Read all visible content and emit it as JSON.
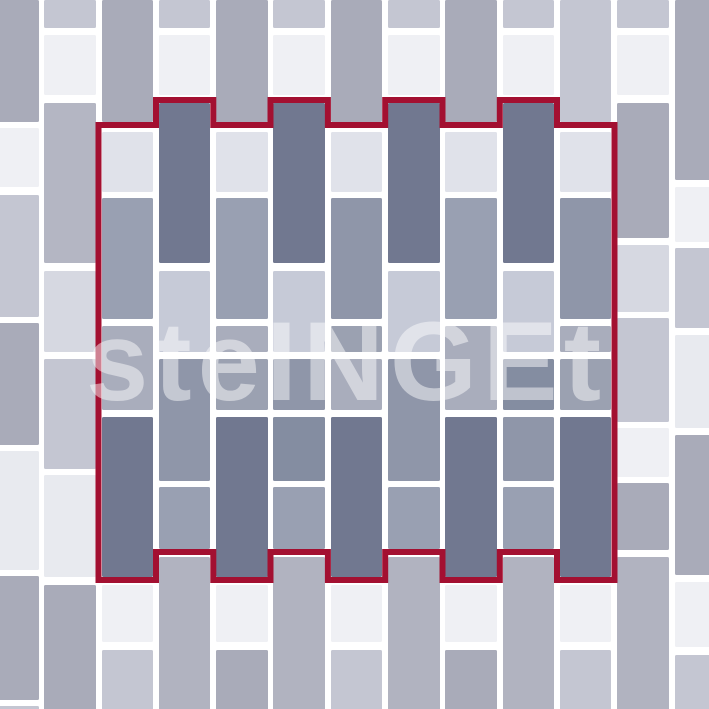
{
  "canvas": {
    "width": 709,
    "height": 709,
    "background": "#ffffff"
  },
  "watermark": {
    "text": "steINGEt",
    "color": "rgba(255,255,255,0.48)"
  },
  "palette": {
    "w": "#eff0f4",
    "l": "#e8eaef",
    "ll": "#d6d8e1",
    "lav": "#c4c6d2",
    "g": "#a9abb9",
    "g2": "#b4b6c3",
    "bG": "#b1b3c0",
    "iL": "#e0e2ea",
    "iP": "#c6cad7",
    "iM": "#99a0b2",
    "iM2": "#8f96a9",
    "iM3": "#848da1",
    "iG": "#a9adbc",
    "iG2": "#9ba1b1",
    "dark": "#717890"
  },
  "grid": {
    "tile_width": 51.6,
    "corner_radius": 1.5,
    "tile_format": "[top_px, height_px, palette_key]"
  },
  "columns": [
    {
      "x": -13.1,
      "tiles": [
        [
          0,
          122,
          "g"
        ],
        [
          128,
          59,
          "w"
        ],
        [
          195,
          122,
          "lav"
        ],
        [
          323,
          122,
          "g"
        ],
        [
          451,
          119,
          "l"
        ],
        [
          576,
          124,
          "g"
        ],
        [
          706,
          14,
          "lav"
        ]
      ]
    },
    {
      "x": 44.2,
      "tiles": [
        [
          0,
          28,
          "lav"
        ],
        [
          35,
          60,
          "w"
        ],
        [
          103,
          160,
          "g2"
        ],
        [
          271,
          81,
          "ll"
        ],
        [
          359,
          110,
          "lav"
        ],
        [
          475,
          102,
          "l"
        ],
        [
          585,
          135,
          "g"
        ]
      ]
    },
    {
      "x": 101.5,
      "tiles": [
        [
          0,
          122,
          "g"
        ],
        [
          132,
          60,
          "iL"
        ],
        [
          198,
          121,
          "iM"
        ],
        [
          326,
          84,
          "iG"
        ],
        [
          417,
          160,
          "dark"
        ],
        [
          585,
          57,
          "w"
        ],
        [
          650,
          70,
          "lav"
        ]
      ]
    },
    {
      "x": 158.8,
      "tiles": [
        [
          0,
          28,
          "lav"
        ],
        [
          35,
          60,
          "w"
        ],
        [
          103,
          160,
          "dark"
        ],
        [
          271,
          81,
          "iP"
        ],
        [
          359,
          122,
          "iM2"
        ],
        [
          487,
          62,
          "iM"
        ],
        [
          557,
          163,
          "bG"
        ]
      ]
    },
    {
      "x": 216.1,
      "tiles": [
        [
          0,
          122,
          "g"
        ],
        [
          132,
          60,
          "iL"
        ],
        [
          198,
          121,
          "iM"
        ],
        [
          326,
          26,
          "iG"
        ],
        [
          359,
          51,
          "iG2"
        ],
        [
          417,
          160,
          "dark"
        ],
        [
          585,
          57,
          "w"
        ],
        [
          650,
          70,
          "g"
        ]
      ]
    },
    {
      "x": 273.4,
      "tiles": [
        [
          0,
          28,
          "lav"
        ],
        [
          35,
          60,
          "w"
        ],
        [
          103,
          160,
          "dark"
        ],
        [
          271,
          81,
          "iP"
        ],
        [
          359,
          51,
          "iM2"
        ],
        [
          417,
          64,
          "iM3"
        ],
        [
          487,
          62,
          "iM"
        ],
        [
          557,
          163,
          "bG"
        ]
      ]
    },
    {
      "x": 330.7,
      "tiles": [
        [
          0,
          122,
          "g"
        ],
        [
          132,
          60,
          "iL"
        ],
        [
          198,
          121,
          "iM2"
        ],
        [
          326,
          26,
          "iG2"
        ],
        [
          359,
          51,
          "iG"
        ],
        [
          417,
          160,
          "dark"
        ],
        [
          585,
          57,
          "w"
        ],
        [
          650,
          70,
          "lav"
        ]
      ]
    },
    {
      "x": 388.0,
      "tiles": [
        [
          0,
          28,
          "lav"
        ],
        [
          35,
          60,
          "w"
        ],
        [
          103,
          160,
          "dark"
        ],
        [
          271,
          81,
          "iP"
        ],
        [
          359,
          122,
          "iM2"
        ],
        [
          487,
          62,
          "iM"
        ],
        [
          557,
          163,
          "bG"
        ]
      ]
    },
    {
      "x": 445.3,
      "tiles": [
        [
          0,
          122,
          "g"
        ],
        [
          132,
          60,
          "iL"
        ],
        [
          198,
          121,
          "iM"
        ],
        [
          326,
          84,
          "iG"
        ],
        [
          417,
          160,
          "dark"
        ],
        [
          585,
          57,
          "w"
        ],
        [
          650,
          70,
          "g"
        ]
      ]
    },
    {
      "x": 502.6,
      "tiles": [
        [
          0,
          28,
          "lav"
        ],
        [
          35,
          60,
          "w"
        ],
        [
          103,
          160,
          "dark"
        ],
        [
          271,
          81,
          "iP"
        ],
        [
          359,
          51,
          "iM3"
        ],
        [
          417,
          64,
          "iM2"
        ],
        [
          487,
          62,
          "iM"
        ],
        [
          557,
          163,
          "bG"
        ]
      ]
    },
    {
      "x": 559.9,
      "tiles": [
        [
          0,
          122,
          "lav"
        ],
        [
          132,
          60,
          "iL"
        ],
        [
          198,
          121,
          "iM2"
        ],
        [
          326,
          26,
          "iG"
        ],
        [
          359,
          51,
          "iG2"
        ],
        [
          417,
          160,
          "dark"
        ],
        [
          585,
          57,
          "w"
        ],
        [
          650,
          70,
          "lav"
        ]
      ]
    },
    {
      "x": 617.2,
      "tiles": [
        [
          0,
          28,
          "lav"
        ],
        [
          35,
          60,
          "w"
        ],
        [
          103,
          135,
          "g"
        ],
        [
          245,
          67,
          "ll"
        ],
        [
          318,
          104,
          "lav"
        ],
        [
          428,
          49,
          "w"
        ],
        [
          483,
          67,
          "g"
        ],
        [
          557,
          163,
          "bG"
        ]
      ]
    },
    {
      "x": 674.5,
      "tiles": [
        [
          0,
          180,
          "g"
        ],
        [
          187,
          55,
          "w"
        ],
        [
          248,
          80,
          "lav"
        ],
        [
          335,
          93,
          "l"
        ],
        [
          435,
          140,
          "g"
        ],
        [
          582,
          65,
          "w"
        ],
        [
          655,
          65,
          "lav"
        ]
      ]
    }
  ],
  "outline": {
    "color": "#a31031",
    "thickness": 6,
    "points": [
      [
        98.5,
        125
      ],
      [
        156,
        125
      ],
      [
        156,
        100
      ],
      [
        213.3,
        100
      ],
      [
        213.3,
        125
      ],
      [
        270.5,
        125
      ],
      [
        270.5,
        100
      ],
      [
        327.9,
        100
      ],
      [
        327.9,
        125
      ],
      [
        385.2,
        125
      ],
      [
        385.2,
        100
      ],
      [
        442.5,
        100
      ],
      [
        442.5,
        125
      ],
      [
        499.8,
        125
      ],
      [
        499.8,
        100
      ],
      [
        557,
        100
      ],
      [
        557,
        125
      ],
      [
        614.5,
        125
      ],
      [
        614.5,
        580
      ],
      [
        557,
        580
      ],
      [
        557,
        552
      ],
      [
        499.8,
        552
      ],
      [
        499.8,
        580
      ],
      [
        442.5,
        580
      ],
      [
        442.5,
        552
      ],
      [
        385.2,
        552
      ],
      [
        385.2,
        580
      ],
      [
        327.9,
        580
      ],
      [
        327.9,
        552
      ],
      [
        270.5,
        552
      ],
      [
        270.5,
        580
      ],
      [
        213.3,
        580
      ],
      [
        213.3,
        552
      ],
      [
        156,
        552
      ],
      [
        156,
        580
      ],
      [
        98.5,
        580
      ]
    ]
  }
}
